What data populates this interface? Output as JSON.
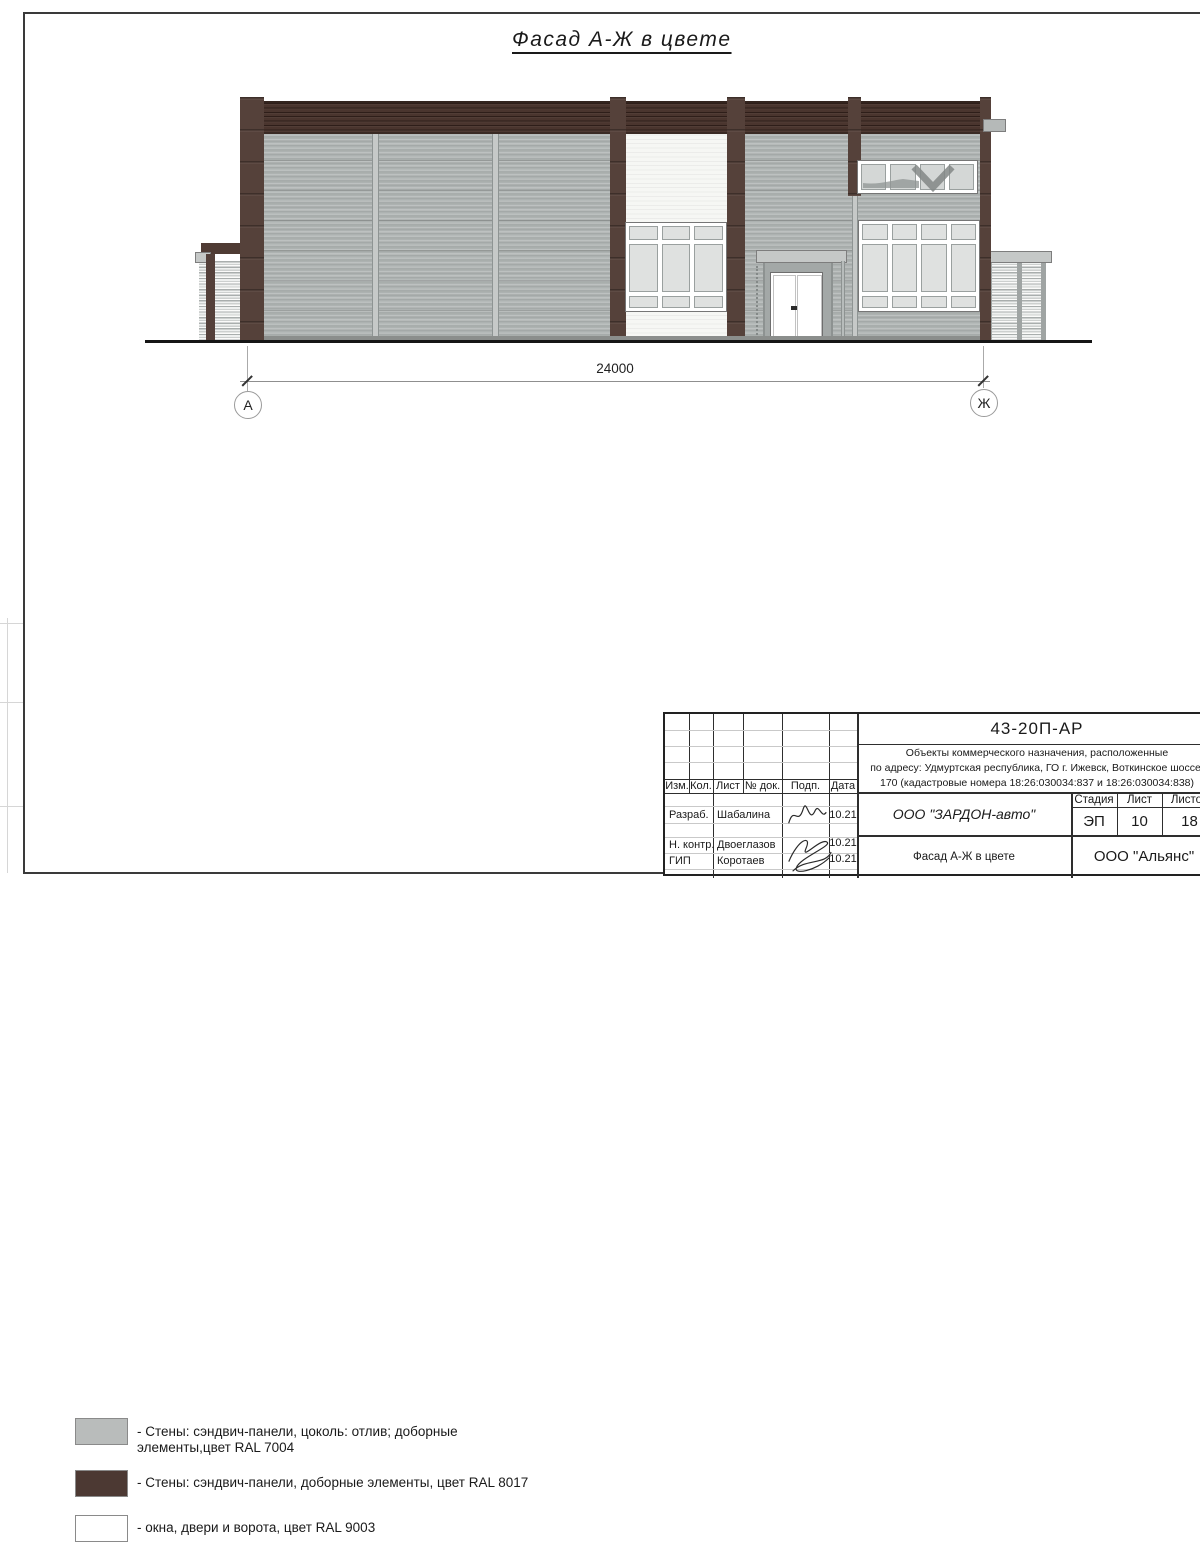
{
  "sheet": {
    "drawing_title": "Фасад А-Ж в цвете",
    "dimension_label": "24000",
    "axis_left": "А",
    "axis_right": "Ж"
  },
  "legend": {
    "items": [
      {
        "color": "#b9bcbb",
        "line1": "- Стены: сэндвич-панели, цоколь: отлив; доборные",
        "line2": "элементы,цвет RAL 7004"
      },
      {
        "color": "#4c3933",
        "line1": "- Стены: сэндвич-панели, доборные элементы, цвет RAL 8017",
        "line2": ""
      },
      {
        "color": "#ffffff",
        "line1": "- окна, двери и ворота, цвет RAL 9003",
        "line2": ""
      }
    ]
  },
  "title_block": {
    "doc_number": "43-20П-АР",
    "project_line1": "Объекты коммерческого назначения, расположенные",
    "project_line2": "по адресу: Удмуртская республика, ГО г. Ижевск, Воткинское шоссе,",
    "project_line3": "170 (кадастровые номера 18:26:030034:837 и 18:26:030034:838)",
    "header_cols": {
      "izm": "Изм.",
      "kol": "Кол.",
      "list": "Лист",
      "doc": "№ док.",
      "podp": "Подп.",
      "data": "Дата"
    },
    "rows": [
      {
        "role": "Разраб.",
        "name": "Шабалина",
        "date": "10.21"
      },
      {
        "role": "Н. контр.",
        "name": "Двоеглазов",
        "date": "10.21"
      },
      {
        "role": "ГИП",
        "name": "Коротаев",
        "date": "10.21"
      }
    ],
    "company": "ООО \"ЗАРДОН-авто\"",
    "stage_label": "Стадия",
    "stage_value": "ЭП",
    "sheet_label": "Лист",
    "sheet_value": "10",
    "sheets_label": "Листов",
    "sheets_value": "18",
    "sheet_title": "Фасад А-Ж в цвете",
    "contractor": "ООО \"Альянс\""
  },
  "colors": {
    "wall_gray_ral7004": "#aeb3b2",
    "wall_brown_ral8017": "#533f38",
    "windows_ral9003": "#ffffff",
    "parapet": "#4a352e",
    "glass": "#dfe1e0"
  }
}
